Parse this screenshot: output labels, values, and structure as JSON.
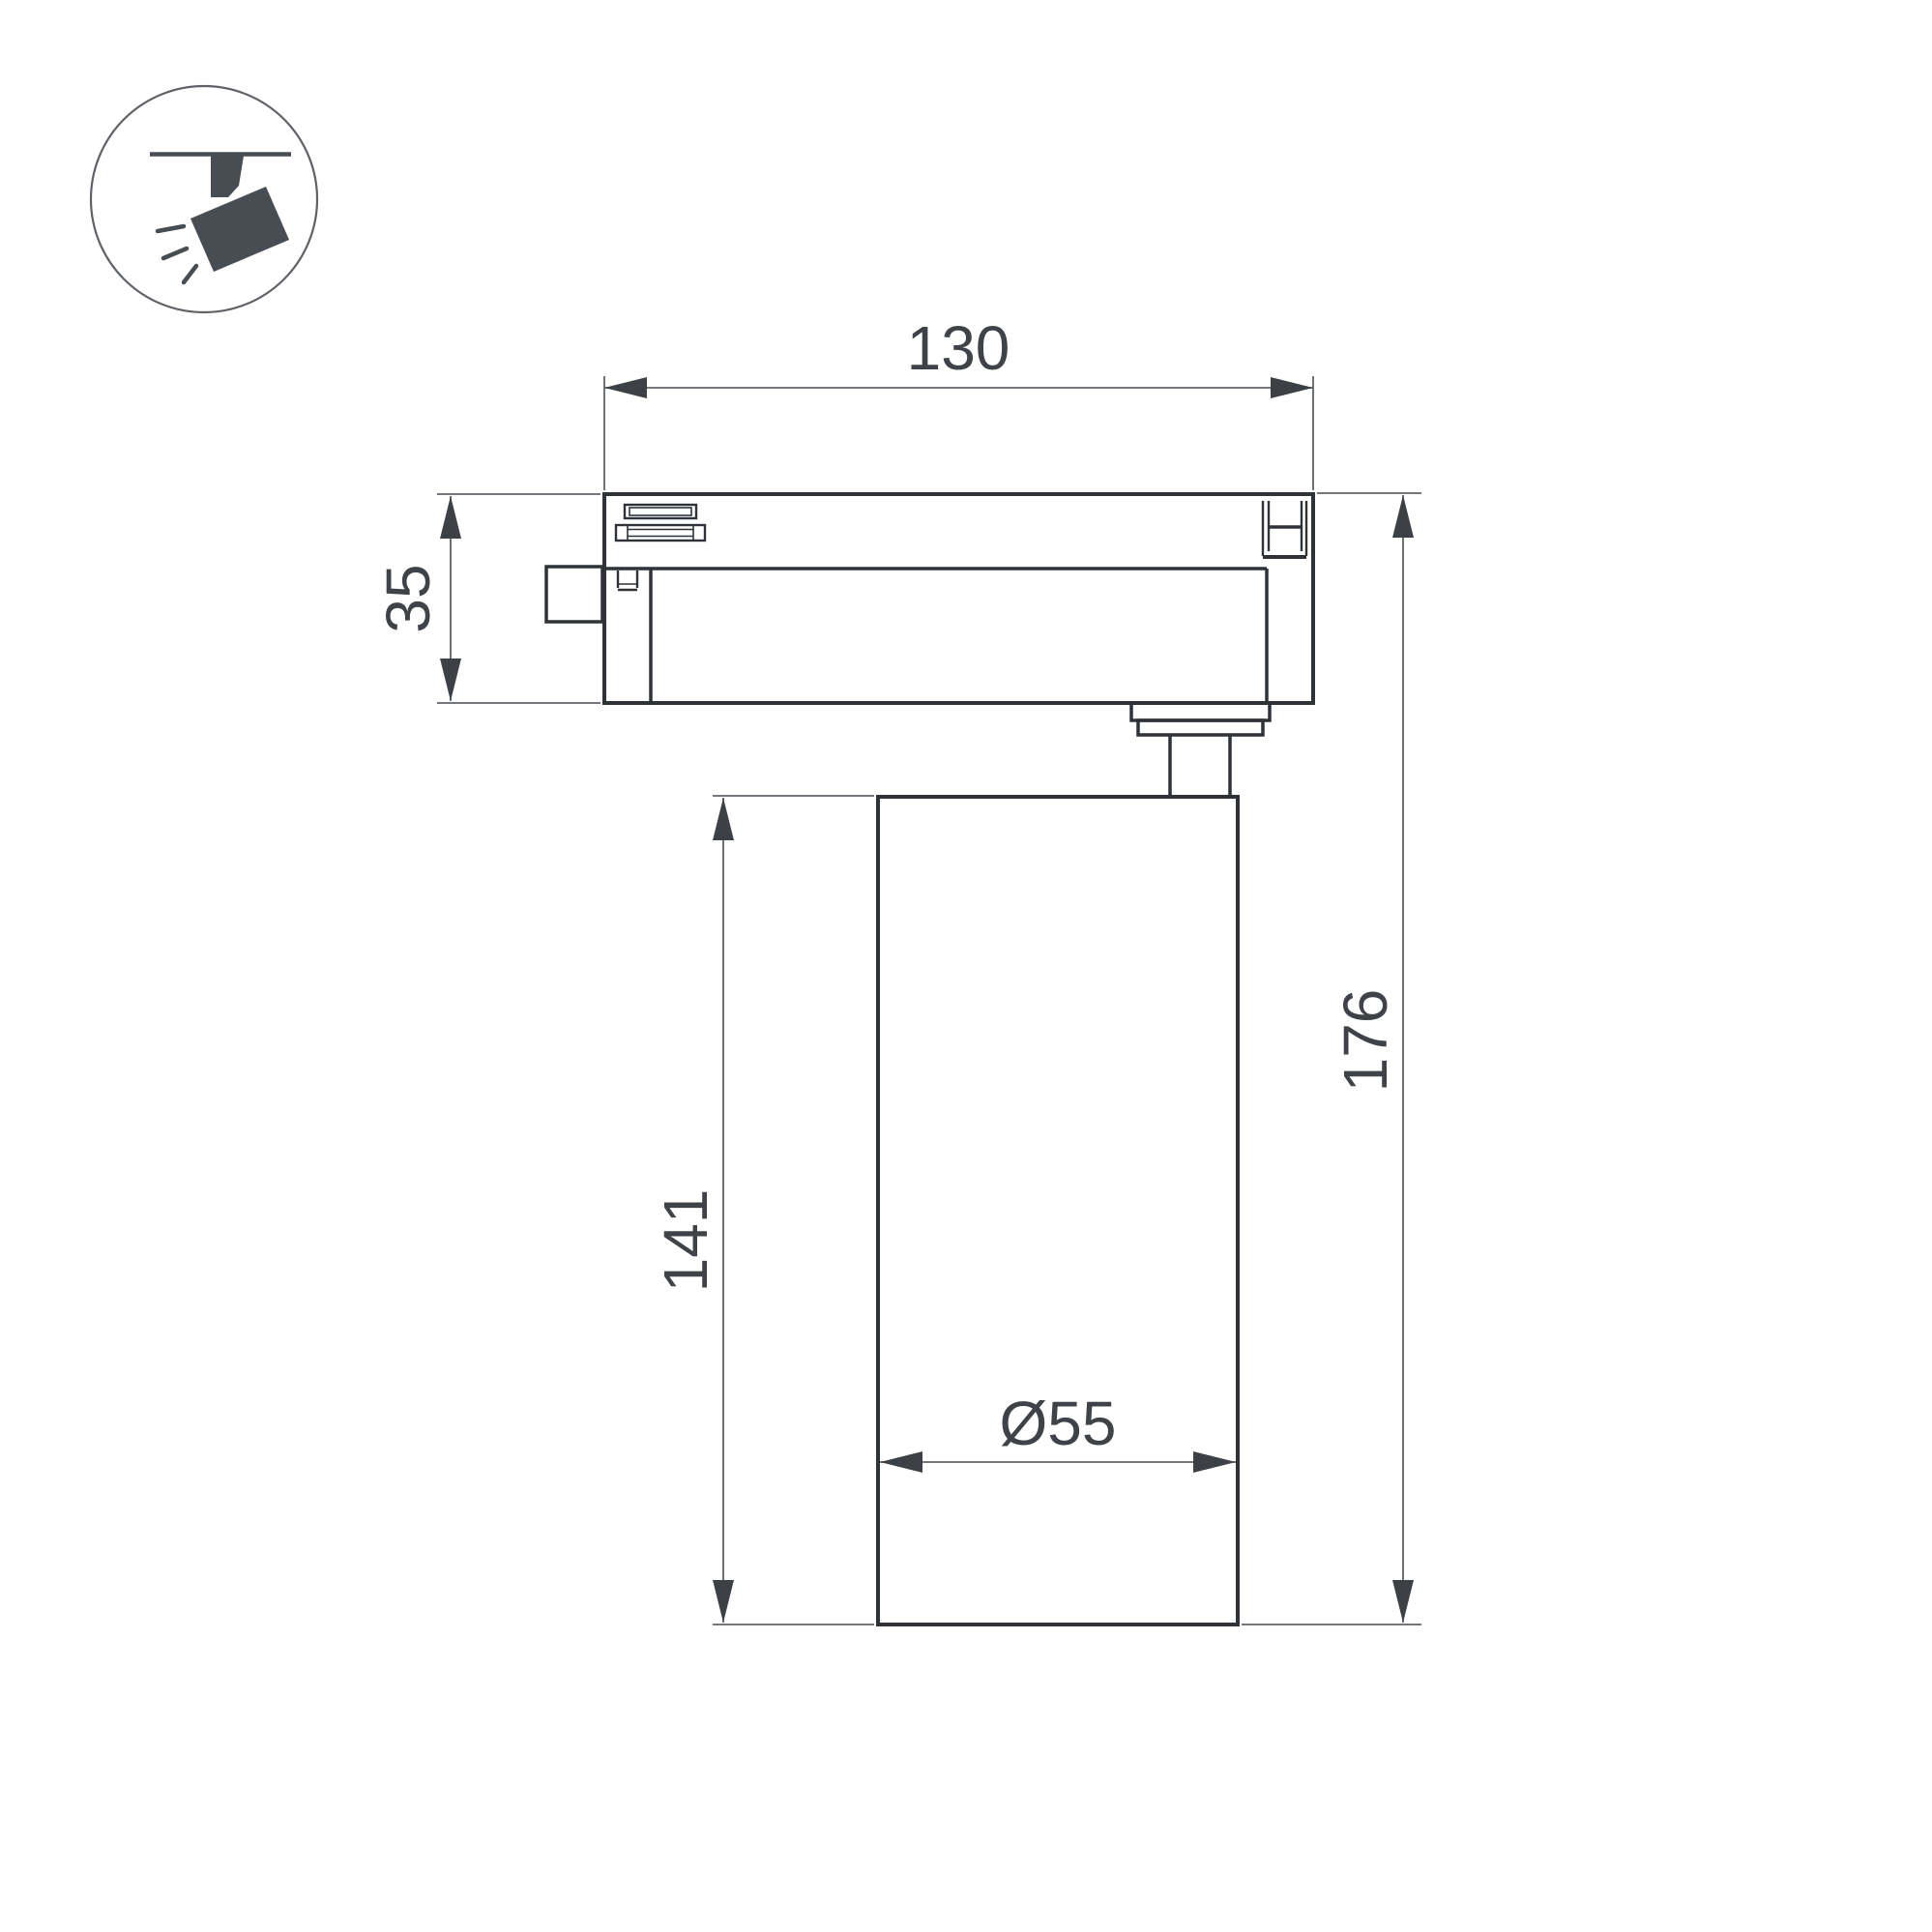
{
  "title": "Track spotlight dimensional drawing",
  "colors": {
    "background": "#ffffff",
    "object-line": "#2f3337",
    "dim-line": "#5f6367",
    "arrow": "#3d4145",
    "text": "#3f4347",
    "icon": "#474d53",
    "icon-circle": "#5f6367"
  },
  "icon": {
    "name": "track-spotlight-icon"
  },
  "dimensions": {
    "track_width": "130",
    "track_height": "35",
    "body_height": "141",
    "total_height": "176",
    "body_diameter": "Ø55"
  }
}
